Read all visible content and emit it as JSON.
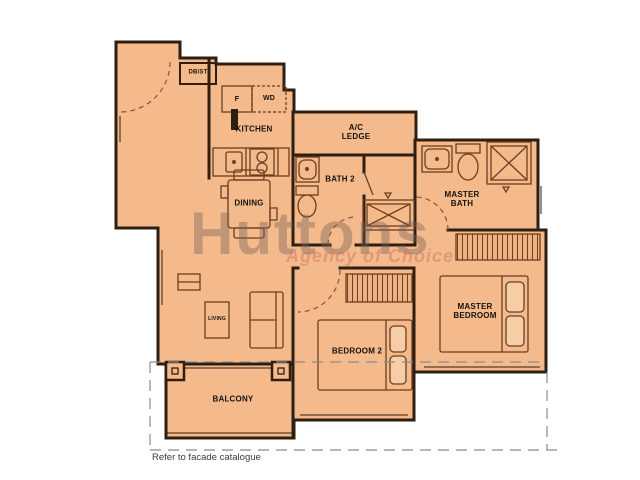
{
  "watermark": {
    "brand": "Huttons",
    "tagline": "Agency of Choice"
  },
  "labels": {
    "dbst": "DB/ST",
    "fridge": "F",
    "washer_dryer": "WD",
    "kitchen": "KITCHEN",
    "ac_ledge": "A/C LEDGE",
    "bath2": "BATH 2",
    "master_bath": "MASTER BATH",
    "dining": "DINING",
    "living": "LIVING",
    "bedroom2": "BEDROOM 2",
    "master_bedroom": "MASTER BEDROOM",
    "balcony": "BALCONY"
  },
  "footnote": "Refer to facade catalogue",
  "colors": {
    "floor": "#f4ba8c",
    "wall": "#301e10",
    "furniture_line": "#6b3f1f",
    "facade_dashed_line": "#8c8c8c",
    "watermark_brand": "#746157",
    "watermark_tagline": "#cb7464",
    "background": "#ffffff"
  }
}
